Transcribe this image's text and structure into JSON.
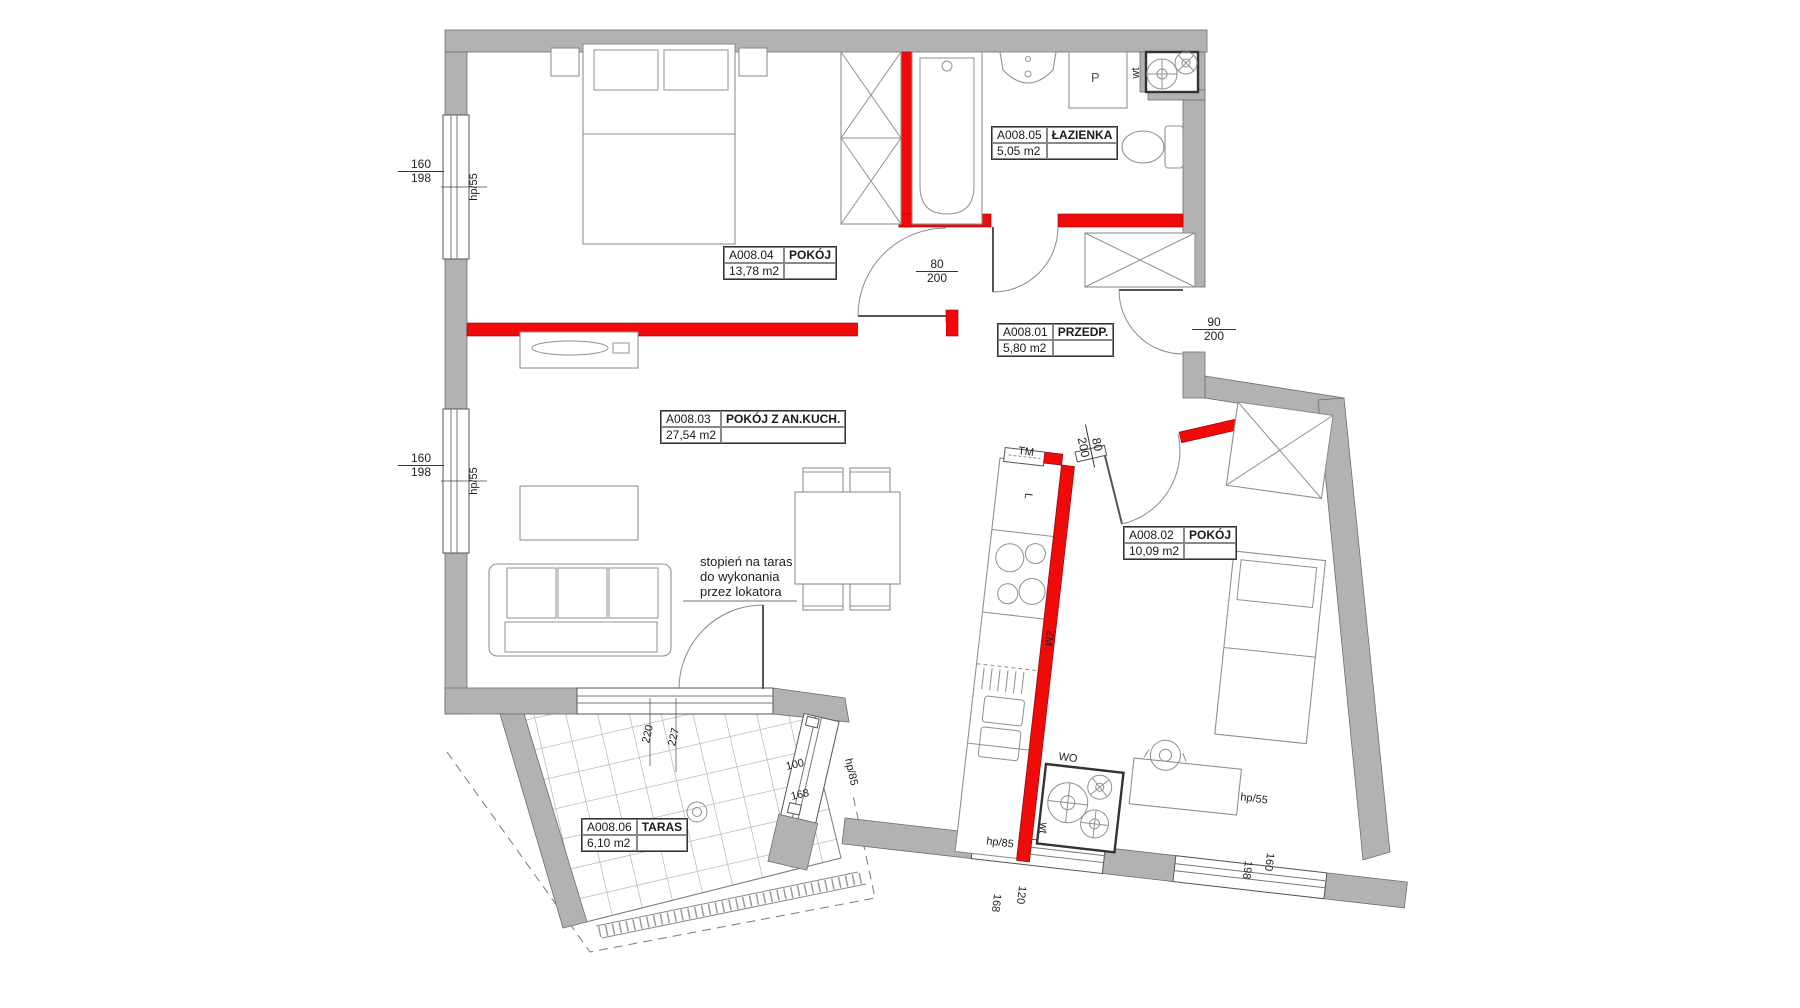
{
  "plan": {
    "rooms": [
      {
        "code": "A008.04",
        "name": "POKÓJ",
        "area": "13,78 m2"
      },
      {
        "code": "A008.05",
        "name": "ŁAZIENKA",
        "area": "5,05 m2"
      },
      {
        "code": "A008.01",
        "name": "PRZEDP.",
        "area": "5,80 m2"
      },
      {
        "code": "A008.03",
        "name": "POKÓJ Z AN.KUCH.",
        "area": "27,54 m2"
      },
      {
        "code": "A008.02",
        "name": "POKÓJ",
        "area": "10,09 m2"
      },
      {
        "code": "A008.06",
        "name": "TARAS",
        "area": "6,10 m2"
      }
    ],
    "note": [
      "stopień na taras",
      "do wykonania",
      "przez lokatora"
    ],
    "fixtures": {
      "washing_machine": "P",
      "fridge": "L",
      "dishwasher": "ZM",
      "meter_box": "TM",
      "water_meter": "WO",
      "vent_top": "wt",
      "vent_bottom": "wt"
    },
    "dims": {
      "win_left_top": {
        "w": "160",
        "h": "198",
        "sill": "hp/55"
      },
      "win_left_bottom": {
        "w": "160",
        "h": "198",
        "sill": "hp/55"
      },
      "door_room04": {
        "w": "80",
        "h": "200"
      },
      "door_entry": {
        "w": "90",
        "h": "200"
      },
      "door_room02": {
        "w": "80",
        "h": "200"
      },
      "win_terrace": {
        "a": "220",
        "b": "227"
      },
      "door_terrace": {
        "w": "100",
        "h": "168",
        "sill": "hp/85"
      },
      "win_bottom": {
        "w": "120",
        "h": "168",
        "sill": "hp/85"
      },
      "win_bottom_right": {
        "w": "198",
        "h": "160",
        "sill": "hp/55"
      }
    },
    "colors": {
      "wall_fill": "#b2b2b2",
      "red_wall": "#f00a0a"
    }
  }
}
